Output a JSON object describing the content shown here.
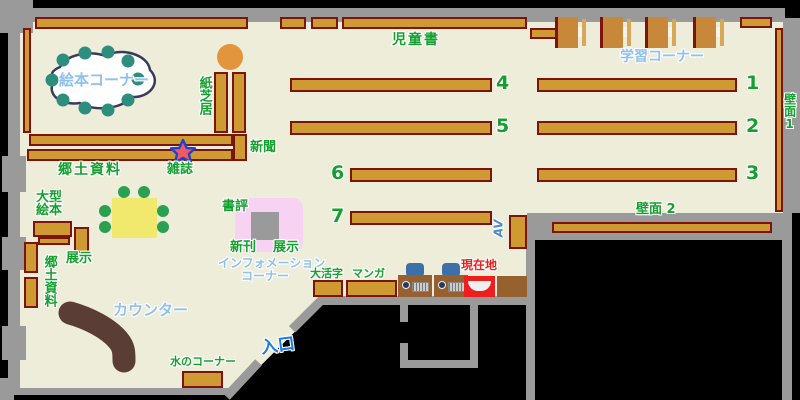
{
  "labels": {
    "jidosho": "児童書",
    "gakushu_corner": "学習コーナー",
    "hekimen1": "壁面1",
    "hekimen2": "壁面 2",
    "ehon_corner": "絵本コーナー",
    "kamishibai": "紙芝居",
    "shinbun": "新聞",
    "zasshi": "雑誌",
    "kyodo_shiryo_upper": "郷土資料",
    "ogata_ehon": "大型絵本",
    "tenji_upper": "展示",
    "kyodo_shiryo_left": "郷土資料",
    "shohyo": "書評",
    "shinkan": "新刊",
    "tenji_display": "展示",
    "information_line1": "インフォメーション",
    "information_line2": "コーナー",
    "counter": "カウンター",
    "mizu_corner": "水のコーナー",
    "entrance": "入口",
    "daikatsuji": "大活字",
    "manga": "マンガ",
    "genzaichi": "現在地",
    "av": "AV"
  },
  "shelf_numbers": {
    "n1": "1",
    "n2": "2",
    "n3": "3",
    "n4": "4",
    "n5": "5",
    "n6": "6",
    "n7": "7"
  },
  "colors": {
    "floor": "#eeedda",
    "wall_gray": "#9a9a9a",
    "outside_black": "#000000",
    "shelf_brown": "#cf9a32",
    "shelf_border": "#7b140c",
    "label_green": "#14a02e",
    "label_lightblue": "#8fc0f0",
    "entrance_blue": "#1b79e8",
    "location_red": "#ec1e1e",
    "counter_brown": "#5a3d35",
    "table_yellow": "#f1e96d",
    "seat_teal": "#2e8e7e",
    "seat_green": "#2aa050",
    "chair_blue": "#3d6fa8",
    "pink_display": "#f8d2f3",
    "stool_orange": "#e2953d",
    "star_fill": "#ee5964",
    "star_outline": "#2340cc"
  }
}
